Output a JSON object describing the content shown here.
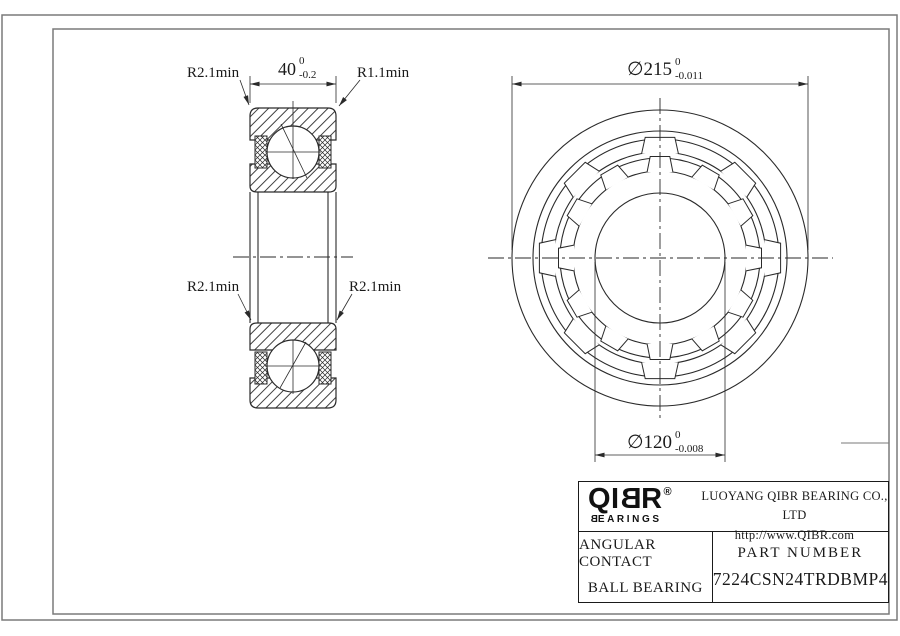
{
  "drawing": {
    "section_view": {
      "label_top_left": "R2.1min",
      "label_top_right": "R1.1min",
      "label_mid_left": "R2.1min",
      "label_mid_right": "R2.1min",
      "width_dim": {
        "value": "40",
        "tol_upper": "0",
        "tol_lower": "-0.2"
      }
    },
    "front_view": {
      "od_dim": {
        "value": "∅215",
        "tol_upper": "0",
        "tol_lower": "-0.011"
      },
      "bore_dim": {
        "value": "∅120",
        "tol_upper": "0",
        "tol_lower": "-0.008"
      }
    },
    "title_block": {
      "logo": {
        "brand_pre": "QI",
        "brand_b": "B",
        "brand_post": "R",
        "registered": "®",
        "sub_b": "B",
        "sub_rest": "EARINGS"
      },
      "company": "LUOYANG QIBR BEARING CO., LTD",
      "website": "http://www.QIBR.com",
      "product_line1": "ANGULAR CONTACT",
      "product_line2": "BALL BEARING",
      "part_number_label": "PART NUMBER",
      "part_number": "7224CSN24TRDBMP4"
    },
    "colors": {
      "line": "#2a2a2a",
      "frame": "#7a7a7a",
      "text": "#1a1a1a",
      "background": "#ffffff"
    }
  }
}
